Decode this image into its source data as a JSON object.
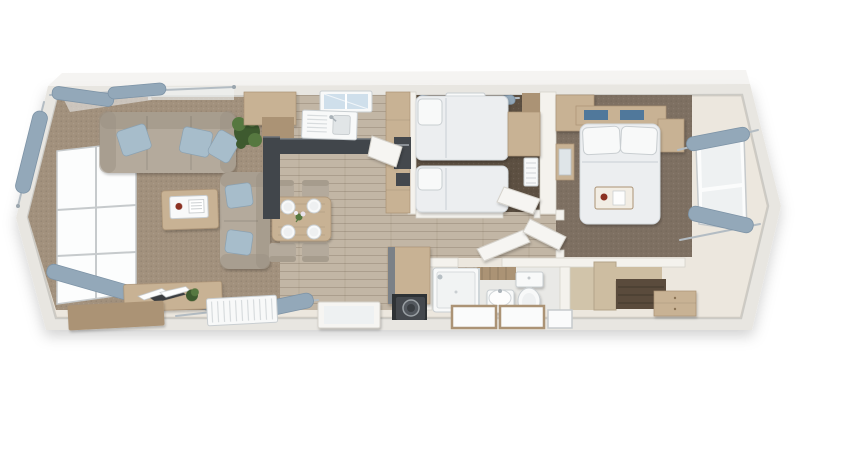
{
  "scene": {
    "label": "3D top-down floor plan render of a two-bedroom holiday lodge with open-plan lounge, dining area and kitchen, hallway, twin bedroom, shower room, utility cupboard and a double bedroom with dressing area",
    "canvas": {
      "width": 858,
      "height": 460
    }
  },
  "palette": {
    "bg": "#ffffff",
    "wallFace": "#e8e6e1",
    "wallTop": "#f1f0ed",
    "wallInner": "#f4f2ed",
    "wallEdge": "#d5d2ca",
    "floorCream": "#ece7de",
    "floorWood": "#c2b6a5",
    "plankLine": "#a89c8a",
    "carpetLiving": "#a2917d",
    "carpetTwin": "#5d5042",
    "carpetMaster": "#7e7062",
    "floorBath": "#e9e9e6",
    "woodFurniture": "#c8b294",
    "woodFurnitureDark": "#ab9375",
    "woodPanel": "#cdbda1",
    "worktop": "#41464b",
    "sofa": "#b4aa9c",
    "sofaShade": "#9c9284",
    "cushion": "#a7bdcb",
    "bedding": "#eceef0",
    "beddingShade": "#d4d9dd",
    "fixtureWhite": "#f8f9f9",
    "fixtureShade": "#c9ced1",
    "glass": "#eef1f2",
    "glassSky": "#cfdfeb",
    "curtain": "#93a8b9",
    "curtainRod": "#b3bcc3",
    "doorLeaf": "#f6f5f2",
    "featureWall": "#5a4b3c",
    "appliance": "#44484d",
    "plantLight": "#567840",
    "plantDark": "#3e5a2f",
    "accentCup": "#8c3023",
    "runnerBlue": "#50789b"
  },
  "rooms": [
    {
      "id": "living-area",
      "contents": [
        "corner-sofa",
        "loveseat-sofa",
        "blue-scatter-cushions",
        "coffee-table-with-tray",
        "media-unit-with-magazines",
        "storage-bench",
        "radiator",
        "potted-plant",
        "tall-window",
        "curtains"
      ]
    },
    {
      "id": "dining-area",
      "contents": [
        "dining-table",
        "four-chairs",
        "four-place-settings",
        "flower-posy"
      ]
    },
    {
      "id": "kitchen",
      "contents": [
        "sink-with-drainer",
        "dark-worktop",
        "overhead-cabinet",
        "tall-cabinet",
        "oven",
        "open-fridge-door",
        "roof-light"
      ]
    },
    {
      "id": "hallway",
      "contents": [
        "open-doors"
      ]
    },
    {
      "id": "twin-bedroom",
      "contents": [
        "two-single-beds",
        "wardrobe",
        "shelf",
        "radiator",
        "roof-light",
        "curtains"
      ]
    },
    {
      "id": "shower-room",
      "contents": [
        "shower-enclosure",
        "washbasin",
        "toilet",
        "wood-panel-wall",
        "frosted-windows"
      ]
    },
    {
      "id": "utility-cupboard",
      "contents": [
        "washing-machine",
        "wood-cabinet"
      ]
    },
    {
      "id": "master-bedroom",
      "contents": [
        "double-bed",
        "two-pillows",
        "breakfast-tray",
        "headboard-shelf",
        "blue-runners",
        "nightstand",
        "wardrobe",
        "vanity-mirror",
        "dressing-nook",
        "feature-wall",
        "bench-drawers",
        "window",
        "curtains"
      ]
    }
  ]
}
